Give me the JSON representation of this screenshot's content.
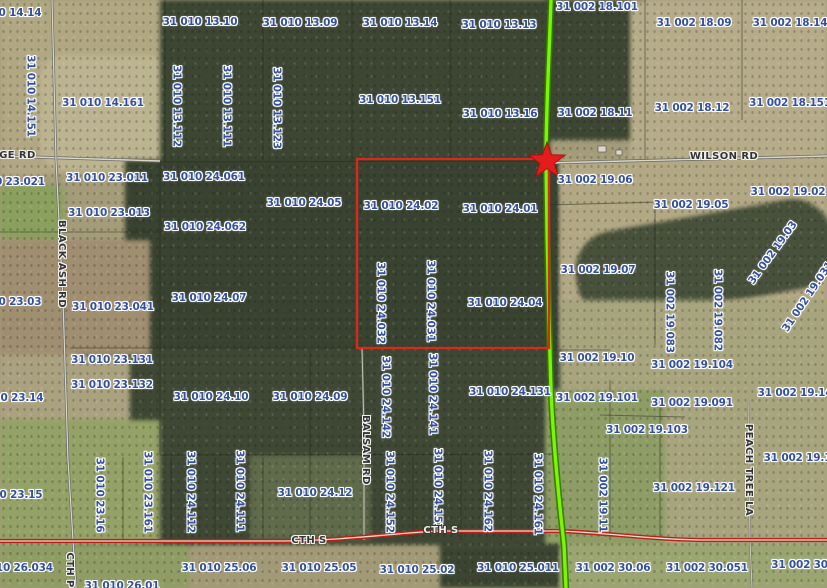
{
  "colors": {
    "parcel_text": "#33509c",
    "road_text": "#2f343a",
    "road_text_light": "#f0efe8",
    "route_highlight": "#7df400",
    "route_casing": "#2f7d00",
    "cth_s": "#b62319",
    "selection": "#d9281c",
    "star": "#e51c1c",
    "road_fill": "#d9d5c9",
    "road_casing": "#6b6b66"
  },
  "map": {
    "marker": {
      "shape": "star",
      "x": 547,
      "y": 161
    },
    "selection_rect": {
      "x": 357,
      "y": 159,
      "w": 192,
      "h": 189
    },
    "parcel_labels": [
      {
        "text": "31 010 14.14",
        "x": 4,
        "y": 13
      },
      {
        "text": "31 010 13.10",
        "x": 200,
        "y": 22
      },
      {
        "text": "31 010 13.09",
        "x": 300,
        "y": 23
      },
      {
        "text": "31 010 13.14",
        "x": 400,
        "y": 23
      },
      {
        "text": "31 010 13.13",
        "x": 499,
        "y": 25
      },
      {
        "text": "31 002 18.101",
        "x": 597,
        "y": 7
      },
      {
        "text": "31 002 18.09",
        "x": 694,
        "y": 23
      },
      {
        "text": "31 002 18.14",
        "x": 790,
        "y": 23
      },
      {
        "text": "31 010 14.151",
        "x": 30,
        "y": 96,
        "r": 90
      },
      {
        "text": "31 010 14.161",
        "x": 103,
        "y": 103
      },
      {
        "text": "31 010 13.112",
        "x": 176,
        "y": 106,
        "r": 90
      },
      {
        "text": "31 010 13.111",
        "x": 226,
        "y": 106,
        "r": 90
      },
      {
        "text": "31 010 13.123",
        "x": 276,
        "y": 108,
        "r": 90
      },
      {
        "text": "31 010 13.151",
        "x": 400,
        "y": 100
      },
      {
        "text": "31 010 13.16",
        "x": 500,
        "y": 114
      },
      {
        "text": "31 002 18.11",
        "x": 595,
        "y": 113
      },
      {
        "text": "31 002 18.12",
        "x": 692,
        "y": 108
      },
      {
        "text": "31 002 18.151",
        "x": 790,
        "y": 103
      },
      {
        "text": "31 002 19.06",
        "x": 595,
        "y": 180
      },
      {
        "text": "31 002 19.02",
        "x": 788,
        "y": 192
      },
      {
        "text": "31 010 23.021",
        "x": 4,
        "y": 182
      },
      {
        "text": "31 010 23.011",
        "x": 107,
        "y": 178
      },
      {
        "text": "31 010 24.061",
        "x": 204,
        "y": 177
      },
      {
        "text": "31 010 23.013",
        "x": 109,
        "y": 213
      },
      {
        "text": "31 010 24.062",
        "x": 205,
        "y": 227
      },
      {
        "text": "31 010 24.05",
        "x": 304,
        "y": 203
      },
      {
        "text": "31 010 24.02",
        "x": 401,
        "y": 206
      },
      {
        "text": "31 010 24.01",
        "x": 500,
        "y": 209
      },
      {
        "text": "31 002 19.05",
        "x": 691,
        "y": 205
      },
      {
        "text": "31 002 19.07",
        "x": 598,
        "y": 270
      },
      {
        "text": "31 002 19.03",
        "x": 773,
        "y": 253,
        "r": -54
      },
      {
        "text": "31 010 23.03",
        "x": 4,
        "y": 302
      },
      {
        "text": "31 010 23.041",
        "x": 113,
        "y": 307
      },
      {
        "text": "31 010 24.07",
        "x": 209,
        "y": 298
      },
      {
        "text": "31 010 24.032",
        "x": 380,
        "y": 303,
        "r": 90
      },
      {
        "text": "31 010 24.031",
        "x": 430,
        "y": 301,
        "r": 90
      },
      {
        "text": "31 010 24.04",
        "x": 505,
        "y": 303
      },
      {
        "text": "31 002 19.083",
        "x": 669,
        "y": 312,
        "r": 90
      },
      {
        "text": "31 002 19.082",
        "x": 717,
        "y": 310,
        "r": 90
      },
      {
        "text": "31 002 19.031",
        "x": 808,
        "y": 297,
        "r": -56
      },
      {
        "text": "31 010 23.131",
        "x": 112,
        "y": 360
      },
      {
        "text": "31 002 19.10",
        "x": 597,
        "y": 358
      },
      {
        "text": "31 002 19.104",
        "x": 692,
        "y": 365
      },
      {
        "text": "31 010 23.132",
        "x": 112,
        "y": 385
      },
      {
        "text": "31 010 23.14",
        "x": 6,
        "y": 398
      },
      {
        "text": "31 010 24.10",
        "x": 211,
        "y": 397
      },
      {
        "text": "31 010 24.09",
        "x": 310,
        "y": 397
      },
      {
        "text": "31 010 24.142",
        "x": 385,
        "y": 397,
        "r": 90
      },
      {
        "text": "31 010 24.141",
        "x": 432,
        "y": 394,
        "r": 90
      },
      {
        "text": "31 010 24.131",
        "x": 510,
        "y": 392
      },
      {
        "text": "31 002 19.101",
        "x": 597,
        "y": 398
      },
      {
        "text": "31 002 19.091",
        "x": 692,
        "y": 403
      },
      {
        "text": "31 002 19.14",
        "x": 795,
        "y": 393
      },
      {
        "text": "31 002 19.103",
        "x": 647,
        "y": 430
      },
      {
        "text": "31 002 19.15",
        "x": 801,
        "y": 458
      },
      {
        "text": "31 010 23.15",
        "x": 5,
        "y": 495
      },
      {
        "text": "31 010 23.16",
        "x": 99,
        "y": 495,
        "r": 90
      },
      {
        "text": "31 010 23.161",
        "x": 147,
        "y": 492,
        "r": 90
      },
      {
        "text": "31 010 24.112",
        "x": 190,
        "y": 492,
        "r": 90
      },
      {
        "text": "31 010 24.111",
        "x": 239,
        "y": 491,
        "r": 90
      },
      {
        "text": "31 010 24.12",
        "x": 315,
        "y": 493
      },
      {
        "text": "31 010 24.152",
        "x": 389,
        "y": 492,
        "r": 90
      },
      {
        "text": "31 010 24.151",
        "x": 437,
        "y": 489,
        "r": 90
      },
      {
        "text": "31 010 24.162",
        "x": 487,
        "y": 491,
        "r": 90
      },
      {
        "text": "31 010 24.161",
        "x": 537,
        "y": 494,
        "r": 90
      },
      {
        "text": "31 002 19.11",
        "x": 602,
        "y": 495,
        "r": 90
      },
      {
        "text": "31 002 19.121",
        "x": 694,
        "y": 488
      },
      {
        "text": "31 010 26.034",
        "x": 12,
        "y": 568
      },
      {
        "text": "31 010 26.01",
        "x": 122,
        "y": 586
      },
      {
        "text": "31 010 25.06",
        "x": 219,
        "y": 568
      },
      {
        "text": "31 010 25.05",
        "x": 319,
        "y": 568
      },
      {
        "text": "31 010 25.02",
        "x": 417,
        "y": 570
      },
      {
        "text": "31 010 25.011",
        "x": 518,
        "y": 568
      },
      {
        "text": "31 002 30.06",
        "x": 613,
        "y": 568
      },
      {
        "text": "31 002 30.051",
        "x": 707,
        "y": 568
      },
      {
        "text": "31 002 30.0",
        "x": 805,
        "y": 565
      }
    ],
    "road_labels": [
      {
        "text": "RIDGE RD",
        "x": 7,
        "y": 156
      },
      {
        "text": "WILSON RD",
        "x": 724,
        "y": 157
      },
      {
        "text": "BLACK ASH RD",
        "x": 61,
        "y": 264,
        "r": 90
      },
      {
        "text": "BALSAM RD",
        "x": 365,
        "y": 450,
        "r": 90
      },
      {
        "text": "PEACH TREE LA",
        "x": 748,
        "y": 470,
        "r": 90
      },
      {
        "text": "CTH S",
        "x": 309,
        "y": 541
      },
      {
        "text": "CTH S",
        "x": 441,
        "y": 531,
        "light": true
      },
      {
        "text": "CTH P",
        "x": 69,
        "y": 570,
        "r": 90
      }
    ]
  }
}
